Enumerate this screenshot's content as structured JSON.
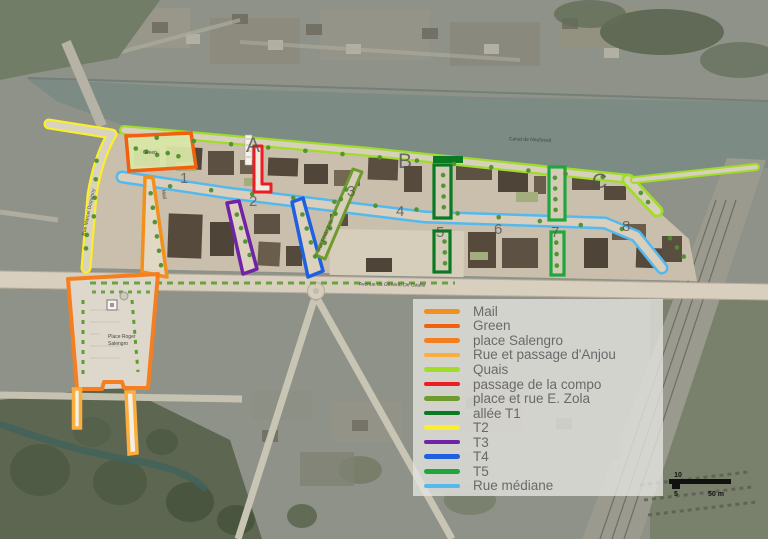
{
  "legend": {
    "items": [
      {
        "label": "Mail",
        "color": "#F1901C"
      },
      {
        "label": "Green",
        "color": "#F2600D"
      },
      {
        "label": "place Salengro",
        "color": "#F57F20"
      },
      {
        "label": "Rue et passage d'Anjou",
        "color": "#FBAD3D"
      },
      {
        "label": "Quais",
        "color": "#9FDD28"
      },
      {
        "label": "passage de la compo",
        "color": "#EC1C24"
      },
      {
        "label": "place et rue E. Zola",
        "color": "#6E9B2D"
      },
      {
        "label": "allée T1",
        "color": "#0A7A22"
      },
      {
        "label": "T2",
        "color": "#FBEE2A"
      },
      {
        "label": "T3",
        "color": "#7023A6"
      },
      {
        "label": "T4",
        "color": "#1F5FE0"
      },
      {
        "label": "T5",
        "color": "#1EA73D"
      },
      {
        "label": "Rue médiane",
        "color": "#53B9EE"
      }
    ]
  },
  "map_labels": {
    "sections": {
      "a": "A",
      "b": "B",
      "c": "C"
    },
    "numbers": [
      "1",
      "2",
      "3",
      "4",
      "5",
      "6",
      "7",
      "8"
    ],
    "canal": "Canal de Neufossé",
    "avenue": "Avenue du Général De Gaulle",
    "place_line1": "Place Roger",
    "place_line2": "Salengro",
    "green_area": "Green",
    "mail_street": "Mail",
    "zola_street": "Rue Emile Zola",
    "west_street": "Rue Marcel Doquinoy"
  },
  "scalebar": {
    "top": "10",
    "bottom_left": "5",
    "bottom_right": "50 m"
  }
}
